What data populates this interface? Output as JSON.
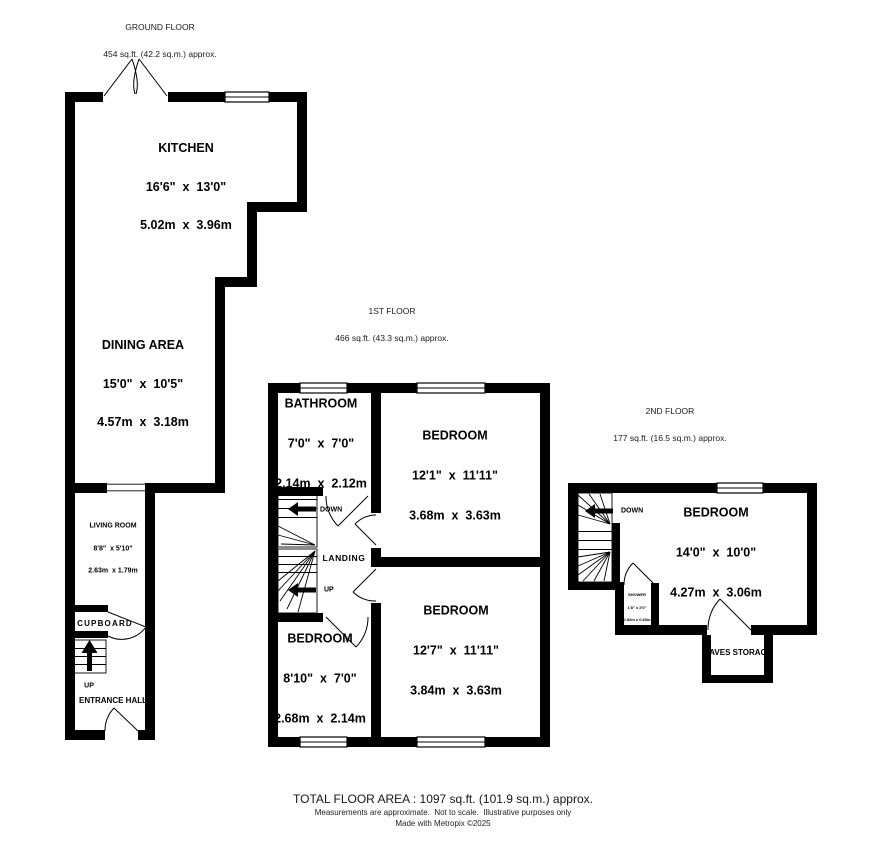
{
  "floors": {
    "ground": {
      "title": "GROUND FLOOR",
      "subtitle": "454 sq.ft. (42.2 sq.m.) approx.",
      "rooms": {
        "kitchen": {
          "name": "KITCHEN",
          "imperial": "16'6\"  x  13'0\"",
          "metric": "5.02m  x  3.96m"
        },
        "dining": {
          "name": "DINING AREA",
          "imperial": "15'0\"  x  10'5\"",
          "metric": "4.57m  x  3.18m"
        },
        "living": {
          "name": "LIVING ROOM",
          "imperial": "8'8\"  x 5'10\"",
          "metric": "2.63m  x 1.79m"
        },
        "cupboard": {
          "name": "CUPBOARD"
        },
        "hall": {
          "name": "ENTRANCE HALL"
        },
        "up_label": "UP"
      }
    },
    "first": {
      "title": "1ST FLOOR",
      "subtitle": "466 sq.ft. (43.3 sq.m.) approx.",
      "rooms": {
        "bathroom": {
          "name": "BATHROOM",
          "imperial": "7'0\"  x  7'0\"",
          "metric": "2.14m  x  2.12m"
        },
        "bedroom1": {
          "name": "BEDROOM",
          "imperial": "12'1\"  x  11'11\"",
          "metric": "3.68m  x  3.63m"
        },
        "bedroom2": {
          "name": "BEDROOM",
          "imperial": "12'7\"  x  11'11\"",
          "metric": "3.84m  x  3.63m"
        },
        "bedroom3": {
          "name": "BEDROOM",
          "imperial": "8'10\"  x  7'0\"",
          "metric": "2.68m  x  2.14m"
        },
        "landing": {
          "name": "LANDING"
        },
        "down_label": "DOWN",
        "up_label": "UP"
      }
    },
    "second": {
      "title": "2ND FLOOR",
      "subtitle": "177 sq.ft. (16.5 sq.m.) approx.",
      "rooms": {
        "bedroom": {
          "name": "BEDROOM",
          "imperial": "14'0\"  x  10'0\"",
          "metric": "4.27m  x  3.06m"
        },
        "shower": {
          "name": "SHOWER",
          "imperial": "1'8\" x 2'0\"",
          "metric": "0.52m x 0.60m"
        },
        "eaves": {
          "name": "EAVES STORAGE"
        },
        "down_label": "DOWN"
      }
    }
  },
  "footer": {
    "total": "TOTAL FLOOR AREA : 1097 sq.ft. (101.9 sq.m.) approx.",
    "disclaimer": "Measurements are approximate.  Not to scale.  Illustrative purposes only",
    "credit": "Made with Metropix ©2025"
  },
  "colors": {
    "wall": "#000000",
    "background": "#ffffff",
    "text": "#000000"
  }
}
